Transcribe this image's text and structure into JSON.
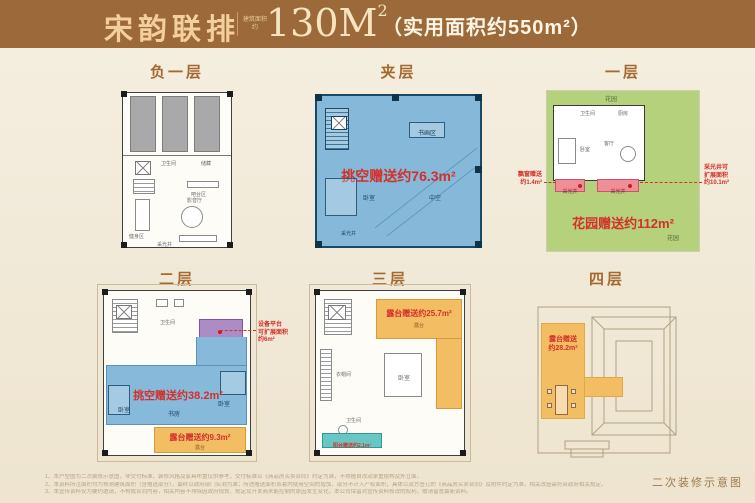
{
  "colors": {
    "band": "#9c6a3a",
    "accent_red": "#d3302a",
    "blue": "#87b9da",
    "green": "#b5d17c",
    "orange": "#f3bd63",
    "purple": "#ad8cc6",
    "teal": "#68c7c2",
    "pink": "#ef8e98",
    "title_brown": "#a5692f"
  },
  "header": {
    "project": "宋韵联排",
    "area_tag_line1": "建筑面积",
    "area_tag_line2": "约",
    "area_main": "130M",
    "area_sup": "2",
    "usable": "（实用面积约550m²）"
  },
  "floors": {
    "b1": {
      "title": "负一层",
      "labels": {
        "bath": "卫生间",
        "storage": "储藏",
        "bar": "吧台区",
        "media": "影音厅",
        "gym": "健身区",
        "well": "采光井"
      }
    },
    "mezz": {
      "title": "夹层",
      "gift": "挑空赠送约76.3m²",
      "labels": {
        "study": "书画区",
        "bed": "卧室",
        "void": "中空",
        "well": "采光井"
      }
    },
    "f1": {
      "title": "一层",
      "gift": "花园赠送约112m²",
      "labels": {
        "garden_top": "花园",
        "bath": "卫生间",
        "kitchen": "厨房",
        "bed": "卧室",
        "living": "客厅",
        "well1": "采光井",
        "well2": "采光井",
        "garden": "花园"
      },
      "ann_left": [
        "飘窗赠送",
        "约1.4m²"
      ],
      "ann_right": [
        "采光井可",
        "扩展面积",
        "约10.1m²"
      ]
    },
    "f2": {
      "title": "二层",
      "gift": "挑空赠送约38.2m²",
      "terrace_gift": "露台赠送约9.3m²",
      "labels": {
        "bath1": "卫生间",
        "bath2": "卫生间",
        "bed1": "卧室",
        "study": "书房",
        "bed2": "卧室",
        "terrace": "露台"
      },
      "ann_right": [
        "设备平台",
        "可扩展面积",
        "约6m²"
      ]
    },
    "f3": {
      "title": "三层",
      "gift": "露台赠送约25.7m²",
      "balcony_gift": "阳台赠送约2.1m²",
      "labels": {
        "terrace": "露台",
        "cloak": "衣帽间",
        "bed": "卧室",
        "bath": "卫生间"
      }
    },
    "f4": {
      "title": "四层",
      "gift_line1": "露台赠送",
      "gift_line2": "约28.2m²"
    }
  },
  "footer": {
    "notes": [
      "1、本户型图为二次装修示意图，非交付标准，装修风格及家具布置仅供参考，交付标准以《商品房买卖合同》约定为准，不得擅自改动承重结构及外立面。",
      "2、本资料所注面积均为预测建筑面积（含赠送部分），最终以政府部门实测为准；所述赠送面积系套内使用空间的增加，部分不计入产权面积，具体以双方签订的《商品房买卖合同》及附件约定为准，相关改造需符合政府相关规定。",
      "3、本宣传资料仅为要约邀请，不构成合同内容，相关内容不排除因政府规划、规定及开发商未能控制的原因发生变化，本公司保留对宣传资料修改的权利，敬请留意最新资料。"
    ],
    "caption": "二次装修示意图"
  }
}
